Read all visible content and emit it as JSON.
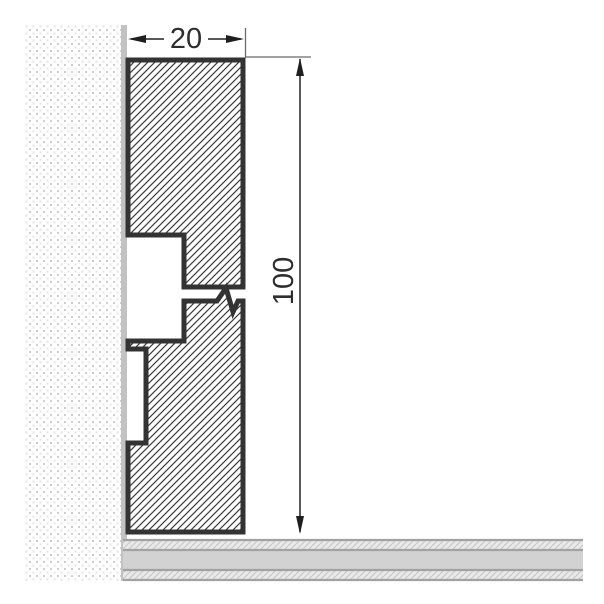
{
  "diagram": {
    "title": "skirting-board-profile-cross-section",
    "labels": {
      "width_dim": "20",
      "height_dim": "100"
    },
    "dimensions": [
      {
        "name": "profile-width",
        "value": "20",
        "orientation": "horizontal"
      },
      {
        "name": "profile-height",
        "value": "100",
        "orientation": "vertical"
      }
    ],
    "components": [
      "wall",
      "skirting-profile-upper-piece",
      "skirting-profile-lower-piece",
      "break-symbol",
      "floor"
    ],
    "colors": {
      "outline": "#333333",
      "dimension_line": "#222222",
      "extension_line": "#6b6b6b",
      "dimension_text": "#2e2e2e",
      "hatch_line": "#3c3c3c",
      "wall_dot": "#cfcfcf",
      "wall_edge": "#c2c2c2",
      "floor_solid": "#d2d2d2",
      "floor_light": "#e9e9e9",
      "floor_hatch": "#c4c4c4",
      "floor_line": "#a2a2a2"
    }
  }
}
